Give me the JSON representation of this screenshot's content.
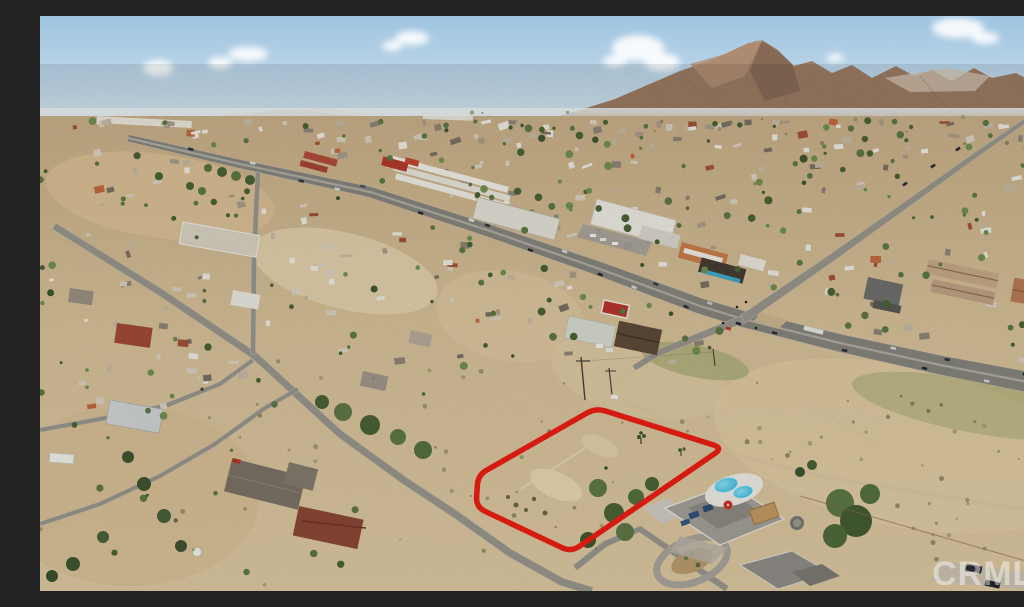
{
  "photo": {
    "kind": "aerial-drone-photo",
    "subject": "Vacant desert land parcel outlined in red beside a highway intersection in a high-desert town with mountains on the horizon",
    "watermark": {
      "text": "CRMLS",
      "color": "#ffffff",
      "opacity": 0.45
    }
  },
  "palette": {
    "sky_top": "#9fc4e0",
    "sky_mid": "#c6dcea",
    "sky_horizon": "#e6edf0",
    "cloud": "#ffffff",
    "far_hills": "#c0b6a6",
    "far_mesa": "#cdc8bb",
    "mountain": "#9a7a62",
    "mountain_light": "#b29076",
    "mountain_shadow": "#7e6350",
    "mountain_scar": "#d0c3af",
    "foothills": "#bb9a7b",
    "terrain_light": "#e7d6b1",
    "terrain_pink": "#dcc096",
    "terrain_dark": "#c2aa81",
    "asphalt": "#85847c",
    "asphalt_light": "#98958c",
    "road_median": "#b4b1a6",
    "road_edge": "#cfcabc",
    "dirt_road": "#d9c59f",
    "veg_dark": "#3f5531",
    "veg_mid": "#5d7845",
    "veg_light": "#77904f",
    "scrub": "#8e8c5f",
    "parcel_red": "#ec1e13",
    "pool_water": "#3fc6e8",
    "pool_deck": "#edebe3",
    "umbrella": "#cc3227",
    "roof_white": "#eceae2",
    "roof_gray": "#a39f98",
    "roof_red": "#a14a35",
    "roof_brown": "#5d4a38",
    "teal_awning": "#3fa8c9",
    "orange_bldg": "#c87c4c"
  },
  "parcel": {
    "outline_points": [
      [
        556,
        392
      ],
      [
        683,
        432
      ],
      [
        531,
        536
      ],
      [
        436,
        491
      ],
      [
        438,
        459
      ]
    ],
    "stroke_width": 5.5,
    "corner_radius": 10
  },
  "roads": [
    {
      "id": "highway",
      "pts": [
        [
          88,
          122
        ],
        [
          200,
          148
        ],
        [
          330,
          176
        ],
        [
          450,
          215
        ],
        [
          560,
          253
        ],
        [
          660,
          290
        ],
        [
          703,
          303
        ],
        [
          800,
          327
        ],
        [
          900,
          349
        ],
        [
          1024,
          373
        ]
      ],
      "w0": 7,
      "w1": 21,
      "color_key": "asphalt",
      "median": true
    },
    {
      "id": "cross-street",
      "pts": [
        [
          1024,
          78
        ],
        [
          940,
          136
        ],
        [
          870,
          186
        ],
        [
          790,
          243
        ],
        [
          703,
          303
        ]
      ],
      "w0": 4,
      "w1": 9,
      "color_key": "asphalt_light"
    },
    {
      "id": "cross-street-south",
      "pts": [
        [
          703,
          303
        ],
        [
          655,
          322
        ],
        [
          618,
          337
        ],
        [
          594,
          352
        ]
      ],
      "w0": 8,
      "w1": 6,
      "color_key": "asphalt_light"
    },
    {
      "id": "neighborhood-road",
      "pts": [
        [
          14,
          210
        ],
        [
          120,
          276
        ],
        [
          215,
          340
        ],
        [
          300,
          418
        ],
        [
          365,
          465
        ],
        [
          415,
          498
        ],
        [
          470,
          537
        ],
        [
          522,
          566
        ],
        [
          552,
          575
        ]
      ],
      "w0": 7,
      "w1": 8,
      "color_key": "asphalt_light"
    },
    {
      "id": "side-road-north",
      "pts": [
        [
          218,
          156
        ],
        [
          214,
          240
        ],
        [
          213,
          338
        ]
      ],
      "w0": 5,
      "w1": 5,
      "color_key": "asphalt_light"
    },
    {
      "id": "side-road-west-upper",
      "pts": [
        [
          0,
          414
        ],
        [
          60,
          403
        ],
        [
          125,
          390
        ],
        [
          180,
          368
        ],
        [
          213,
          344
        ]
      ],
      "w0": 4.5,
      "w1": 4.5,
      "color_key": "asphalt_light"
    },
    {
      "id": "side-road-west-lower",
      "pts": [
        [
          0,
          508
        ],
        [
          60,
          488
        ],
        [
          120,
          460
        ],
        [
          175,
          428
        ],
        [
          225,
          392
        ],
        [
          258,
          373
        ]
      ],
      "w0": 4.5,
      "w1": 4.5,
      "color_key": "asphalt_light"
    },
    {
      "id": "pool-house-street",
      "pts": [
        [
          535,
          552
        ],
        [
          565,
          528
        ],
        [
          600,
          513
        ],
        [
          645,
          544
        ],
        [
          687,
          573
        ]
      ],
      "w0": 6.5,
      "w1": 6.5,
      "color_key": "asphalt_light"
    }
  ],
  "dirt_roads": [
    {
      "pts": [
        [
          575,
          382
        ],
        [
          620,
          400
        ],
        [
          655,
          418
        ],
        [
          683,
          432
        ]
      ],
      "w": 4,
      "opacity": 0.8
    },
    {
      "pts": [
        [
          565,
          388
        ],
        [
          530,
          410
        ],
        [
          495,
          432
        ],
        [
          462,
          452
        ]
      ],
      "w": 3.5,
      "opacity": 0.75
    },
    {
      "pts": [
        [
          594,
          352
        ],
        [
          580,
          362
        ],
        [
          572,
          372
        ],
        [
          569,
          380
        ]
      ],
      "w": 5,
      "opacity": 0.9
    },
    {
      "pts": [
        [
          700,
          440
        ],
        [
          790,
          462
        ],
        [
          900,
          480
        ],
        [
          1024,
          500
        ]
      ],
      "w": 3.5,
      "opacity": 0.7
    },
    {
      "pts": [
        [
          735,
          365
        ],
        [
          775,
          392
        ],
        [
          810,
          412
        ],
        [
          838,
          430
        ]
      ],
      "w": 3,
      "opacity": 0.6
    },
    {
      "pts": [
        [
          420,
          345
        ],
        [
          450,
          360
        ],
        [
          480,
          378
        ],
        [
          505,
          392
        ]
      ],
      "w": 3,
      "opacity": 0.55
    },
    {
      "pts": [
        [
          258,
          452
        ],
        [
          243,
          464
        ],
        [
          230,
          475
        ]
      ],
      "w": 3,
      "opacity": 0.8
    }
  ],
  "highway_vehicles": [
    {
      "x": 150,
      "side": -1,
      "color": "#2e3236"
    },
    {
      "x": 212,
      "side": -1,
      "color": "#dcdcd8"
    },
    {
      "x": 262,
      "side": 1,
      "color": "#33373c"
    },
    {
      "x": 298,
      "side": 1,
      "color": "#d9d9d5"
    },
    {
      "x": 322,
      "side": -1,
      "color": "#505459"
    },
    {
      "x": 382,
      "side": 1,
      "color": "#2b2e33"
    },
    {
      "x": 430,
      "side": -1,
      "color": "#e4e4e0"
    },
    {
      "x": 446,
      "side": -1,
      "color": "#34383d"
    },
    {
      "x": 492,
      "side": 1,
      "color": "#2d3036"
    },
    {
      "x": 523,
      "side": -1,
      "color": "#d8d8d4"
    },
    {
      "x": 562,
      "side": 1,
      "color": "#26292e"
    },
    {
      "x": 596,
      "side": 1,
      "color": "#d4d4d0"
    },
    {
      "x": 614,
      "side": -1,
      "color": "#3a3e44"
    },
    {
      "x": 648,
      "side": 1,
      "color": "#2f3338"
    },
    {
      "x": 668,
      "side": -1,
      "color": "#c9c9c5"
    },
    {
      "x": 700,
      "side": 1,
      "color": "#23262b"
    },
    {
      "x": 736,
      "side": 1,
      "color": "#2c3036"
    },
    {
      "x": 772,
      "side": -1,
      "color": "#e6e6e2",
      "len": 20,
      "wid": 4.5
    },
    {
      "x": 806,
      "side": 1,
      "color": "#2a2d33"
    },
    {
      "x": 852,
      "side": -1,
      "color": "#dedad2"
    },
    {
      "x": 886,
      "side": 1,
      "color": "#26292f"
    },
    {
      "x": 906,
      "side": -1,
      "color": "#2e3338"
    },
    {
      "x": 948,
      "side": 1,
      "color": "#d6d6d2"
    },
    {
      "x": 984,
      "side": -1,
      "color": "#24272c"
    },
    {
      "x": 1008,
      "side": 1,
      "color": "#dcdcda"
    }
  ],
  "cross_street_vehicles": [
    [
      865,
      168
    ],
    [
      893,
      150
    ],
    [
      918,
      133
    ]
  ],
  "generation": {
    "seed": 20240,
    "sprawl_buildings": 300,
    "trees": 250,
    "scrub": 340,
    "building_palette": [
      [
        "#eceae2",
        0.22
      ],
      [
        "#d9d2c2",
        0.16
      ],
      [
        "#c5b9a4",
        0.14
      ],
      [
        "#a99c88",
        0.12
      ],
      [
        "#8f8577",
        0.1
      ],
      [
        "#7a7164",
        0.08
      ],
      [
        "#a35138",
        0.07
      ],
      [
        "#c2693f",
        0.04
      ],
      [
        "#d8cfc0",
        0.07
      ]
    ],
    "tree_palette": [
      [
        "#5d7845",
        0.4
      ],
      [
        "#4a6336",
        0.3
      ],
      [
        "#71904f",
        0.2
      ],
      [
        "#3f5531",
        0.1
      ]
    ],
    "scrub_palette": [
      [
        "#8e8c5f",
        0.4
      ],
      [
        "#9c9a68",
        0.3
      ],
      [
        "#7b7a52",
        0.3
      ]
    ]
  }
}
